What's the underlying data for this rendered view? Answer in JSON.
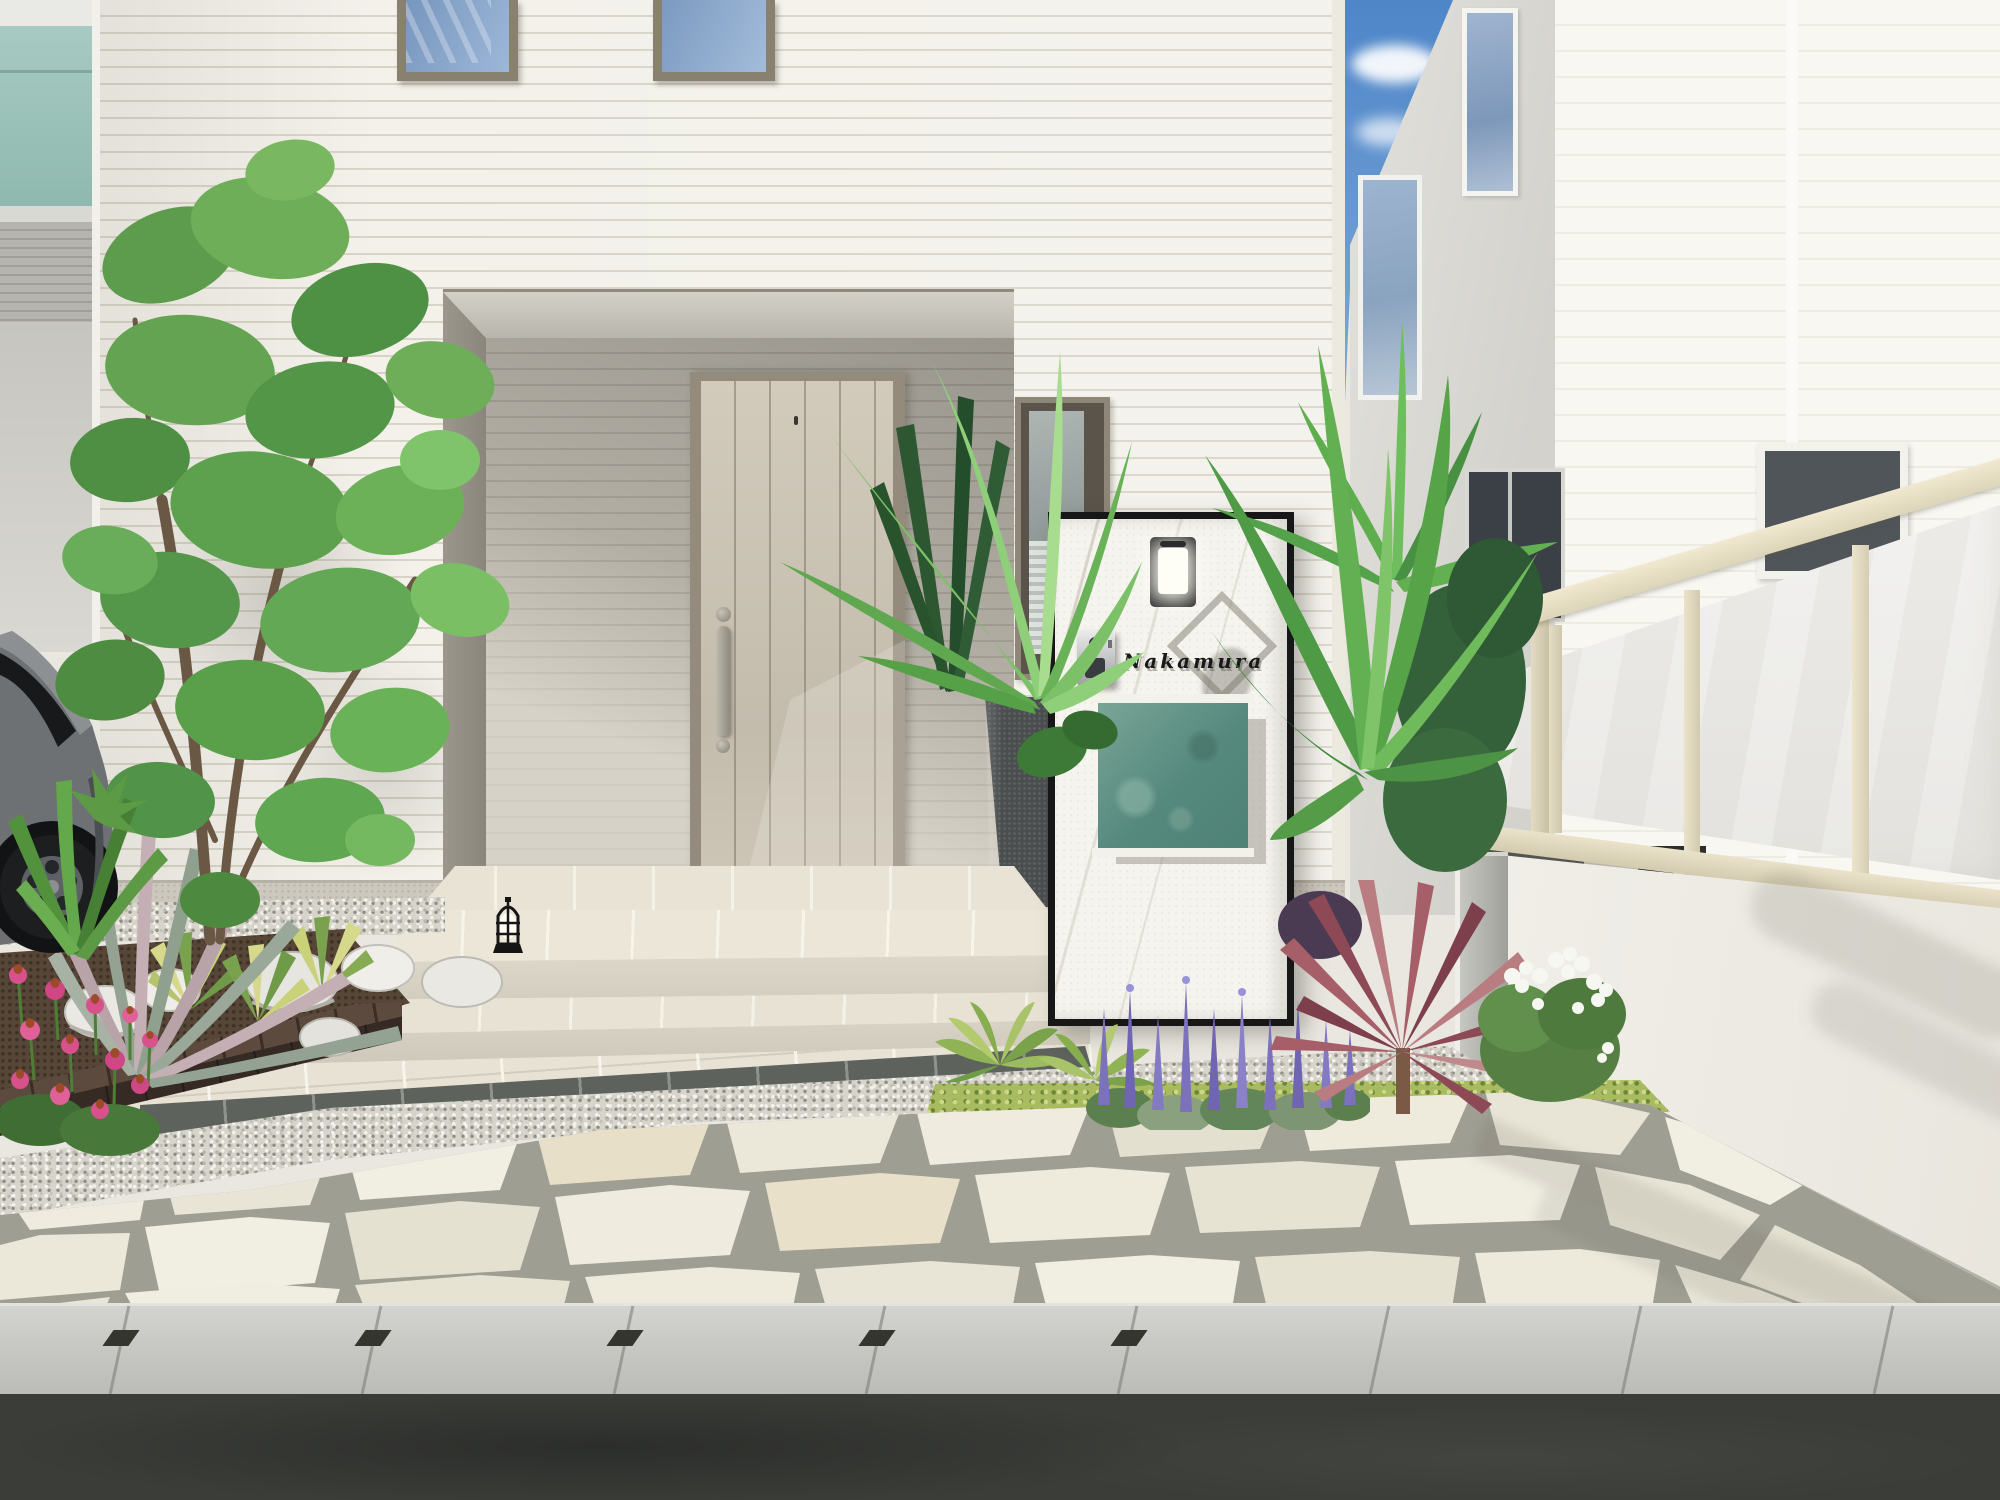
{
  "scene": {
    "kind": "3D exterior architectural rendering",
    "view": "front entrance approach of a modern house with gate post, planting and stone paving"
  },
  "nameplate": {
    "text": "Nakamura"
  },
  "objects": [
    "main-house",
    "front-door",
    "door-handle",
    "entrance-porch",
    "narrow-window",
    "upper-windows",
    "gate-post",
    "wall-lamp",
    "intercom",
    "nameplate",
    "post-box-panel",
    "charcoal-planter",
    "step-lantern",
    "entrance-steps",
    "flagstone-paving",
    "gravel-paving",
    "tile-paving",
    "dark-tile-band",
    "garden-bed-left",
    "echinacea-flowers",
    "boulders",
    "brick-edging",
    "striped-grass",
    "palm-left",
    "palm-right",
    "hostas",
    "purple-salvia",
    "red-cordyline",
    "white-flower-bush",
    "moss-ground",
    "privacy-fence",
    "retaining-wall",
    "neighbor-house-right",
    "neighbor-building-left",
    "car",
    "garden-tree",
    "curb",
    "road",
    "sky"
  ],
  "palette": {
    "sky": "#5d8fcd",
    "house_siding": "#f2f0e9",
    "siding_line": "#d8d4c8",
    "porch_recess": "#aba79d",
    "front_door": "#c9c2b3",
    "door_frame": "#948b7d",
    "teal_wall": "#9cc2b8",
    "postbox_panel": "#679387",
    "post_marble": "#f5f3ee",
    "post_frame": "#161616",
    "fence_frame": "#e7e0c7",
    "fence_panel": "#edecea",
    "flagstone": "#edeadd",
    "flagstone_grout": "#a09f93",
    "gravel": "#d3d1c8",
    "dark_tile": "#5d625c",
    "beige_tile": "#e7e2d3",
    "curb": "#c9cac5",
    "asphalt": "#3b3d39",
    "echinacea_pink": "#d8518d",
    "salvia_purple": "#7b71bd",
    "cordyline_red": "#a05a64",
    "foliage_green": "#5ea04e",
    "car_body": "#75787b"
  }
}
